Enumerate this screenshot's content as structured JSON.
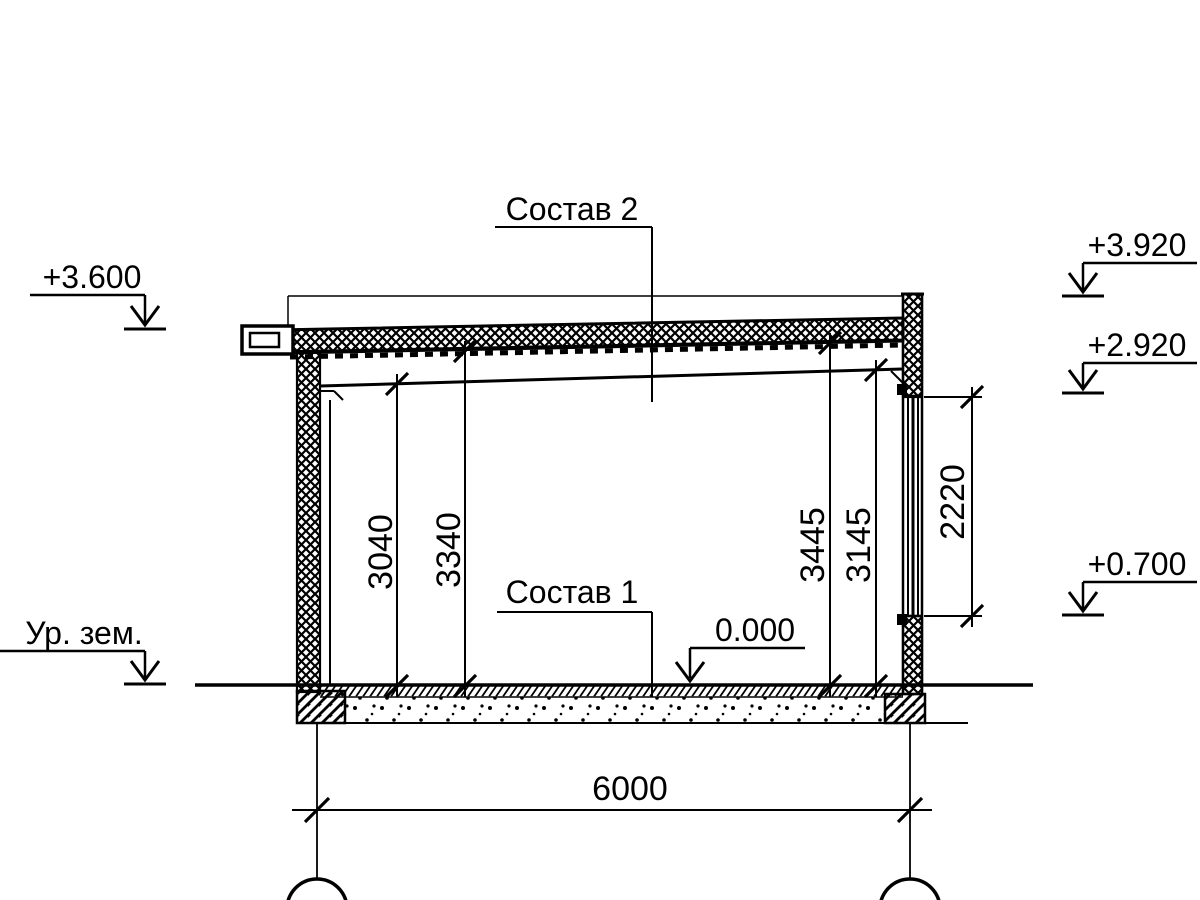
{
  "drawing": {
    "labels": {
      "sostav2": "Состав 2",
      "sostav1": "Состав 1",
      "ground_level": "Ур. зем."
    },
    "elevations": {
      "roof_left": "+3.600",
      "parapet_top": "+3.920",
      "window_top": "+2.920",
      "window_sill": "+0.700",
      "floor": "0.000"
    },
    "dimensions": {
      "height_beam_bottom": "3040",
      "height_deck_left": "3340",
      "height_deck_right": "3445",
      "height_beam_right": "3145",
      "window_height": "2220",
      "span": "6000"
    },
    "colors": {
      "line": "#000000",
      "background": "#ffffff"
    }
  }
}
